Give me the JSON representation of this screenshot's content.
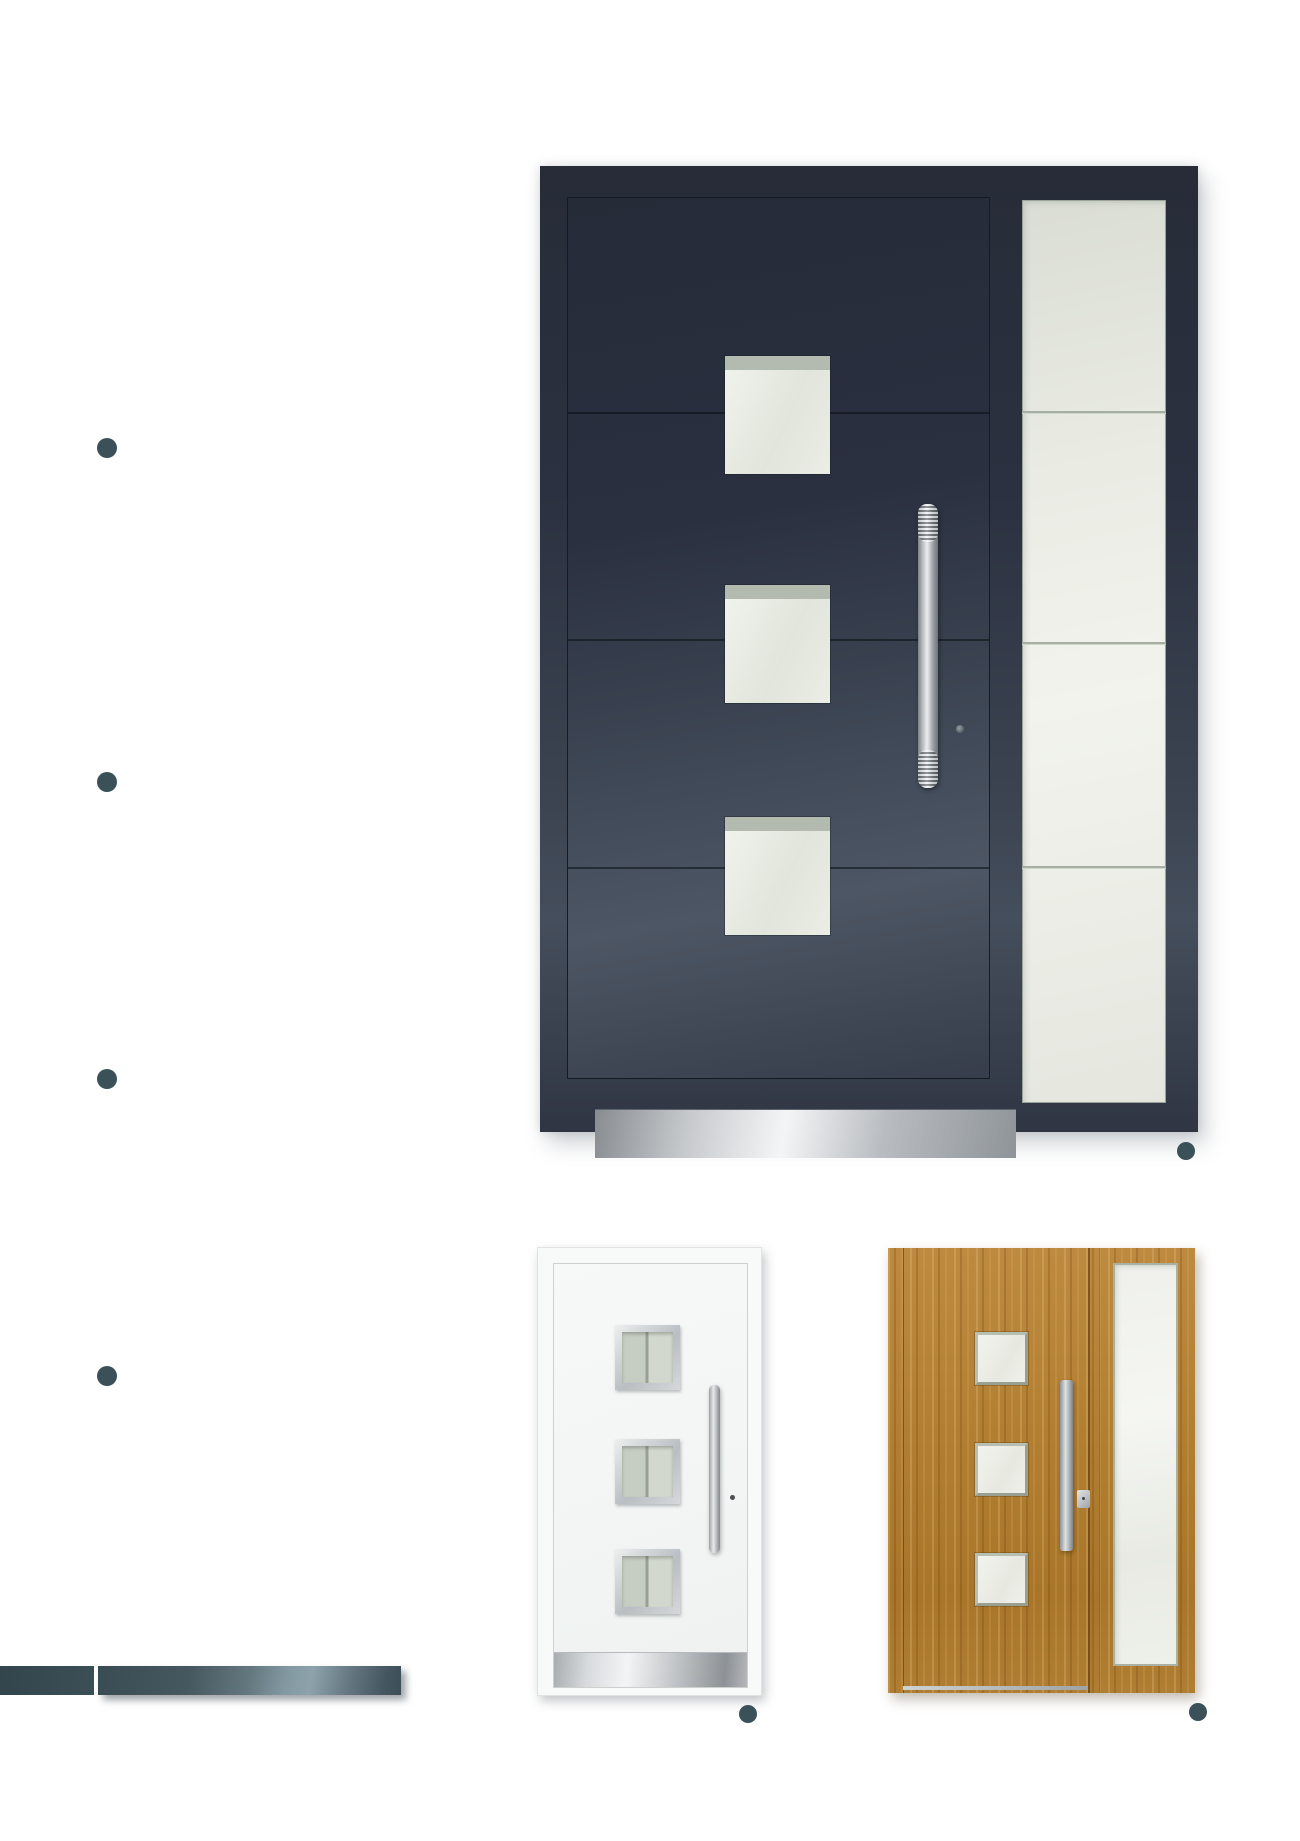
{
  "page": {
    "width": 1300,
    "height": 1841,
    "background": "#ffffff"
  },
  "colors": {
    "accent_teal": "#3a515a",
    "anthracite_frame": "#2a3040",
    "anthracite_dark": "#262b38",
    "anthracite_sheen": "#4c5563",
    "glass_light": "#edefe8",
    "glass_trim_sage": "#adb5aa",
    "stainless_bright": "#f2f4f5",
    "stainless_mid": "#b9bdc1",
    "white_door_body": "#f8faf9",
    "oak_base": "#b07d31",
    "footer_bar_dark": "#35484f",
    "footer_bar_light": "#8da2ab"
  },
  "bullet_markers": {
    "count": 4,
    "shape": "circle",
    "color": "#3a515a"
  },
  "caption_dots": {
    "count": 3,
    "shape": "circle",
    "color": "#3a515a"
  },
  "figures": {
    "main_door": {
      "finish": "anthracite",
      "panel_glass_squares": 3,
      "panel_seams": 3,
      "sidelight_glass_sections": 4,
      "has_bar_handle": true,
      "has_keyhole": true,
      "has_kick_plate": true
    },
    "white_door": {
      "finish": "white",
      "glass_squares": 3,
      "has_bar_handle": true,
      "has_keyhole": true,
      "has_kick_plate": true
    },
    "gold_door": {
      "finish": "golden-oak",
      "glass_squares": 3,
      "has_bar_handle": true,
      "has_lock_plate": true,
      "has_sidelight": true
    }
  },
  "footer_bar": {
    "segments": 2,
    "left_width_px": 94,
    "right_width_px": 303
  }
}
